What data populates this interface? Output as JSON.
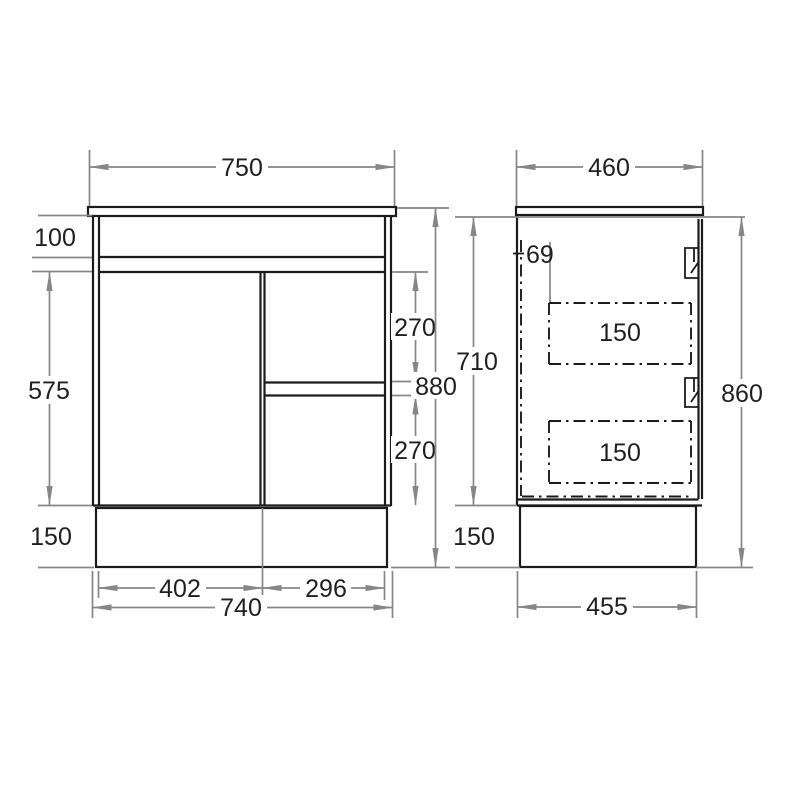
{
  "front_view": {
    "countertop_width": "750",
    "top_band_height": "100",
    "door_height": "575",
    "plinth_height": "150",
    "upper_drawer_height": "270",
    "lower_drawer_height": "270",
    "overall_height": "880",
    "door_width": "402",
    "drawers_width": "296",
    "cabinet_width": "740"
  },
  "side_view": {
    "countertop_depth": "460",
    "drawer_setback": "69",
    "upper_drawer_box_height": "150",
    "lower_drawer_box_height": "150",
    "carcass_height": "710",
    "overall_height": "860",
    "plinth_height": "150",
    "plinth_depth": "455"
  },
  "colors": {
    "drawing_line": "#1b1b1b",
    "dimension_line": "#868686",
    "text": "#1f1f1f",
    "background": "#ffffff"
  }
}
